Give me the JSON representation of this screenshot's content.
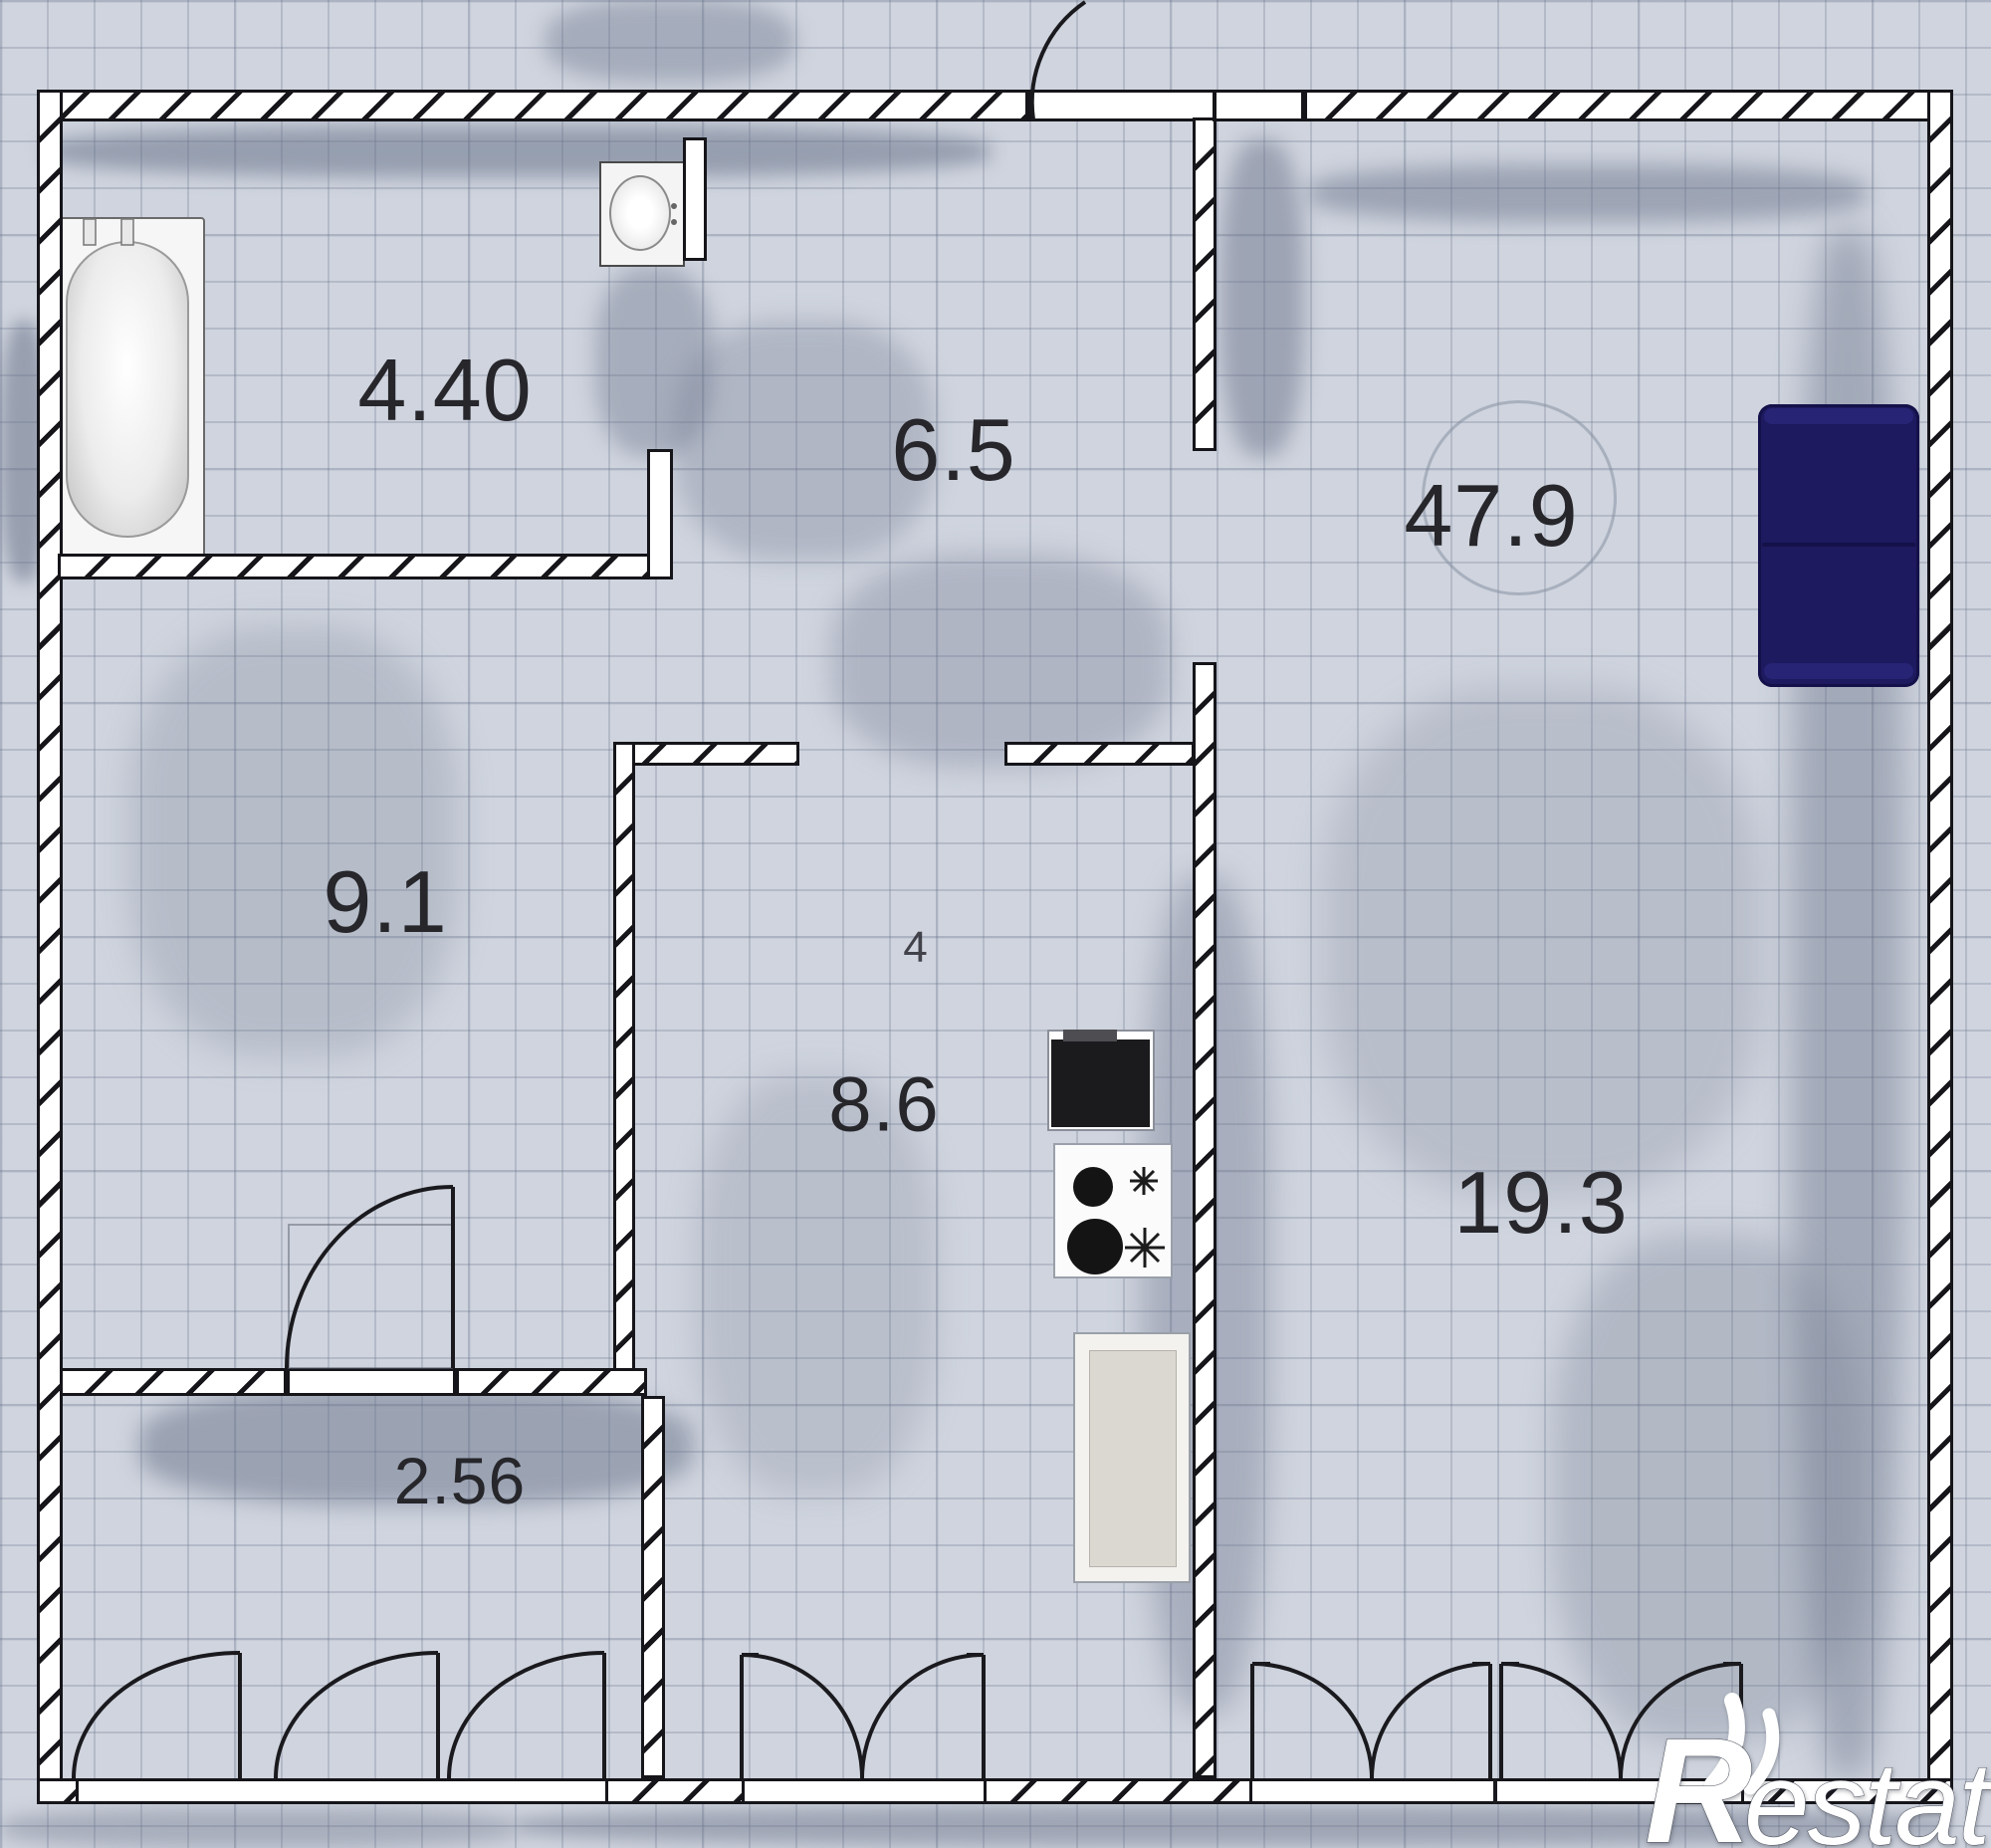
{
  "plan": {
    "type": "apartment floor plan",
    "rooms": {
      "bathroom": {
        "area": "4.40"
      },
      "hallway": {
        "area": "6.5"
      },
      "living_room": {
        "area": "47.9"
      },
      "bedroom": {
        "area": "9.1"
      },
      "kitchen": {
        "area": "8.6",
        "stray_mark": "4"
      },
      "bedroom2": {
        "area": "19.3"
      },
      "closet": {
        "area": "2.56"
      }
    },
    "fixtures": {
      "bathtub": "bathtub",
      "sink": "wash-basin",
      "sofa": "sofa",
      "refrigerator": "refrigerator",
      "stove": "two-burner-stove",
      "cabinet": "appliance-cabinet"
    },
    "watermark": {
      "r": "R",
      "rest": "estate"
    },
    "colors": {
      "background": "#cfd4de",
      "grid": "#6e7c96",
      "wall_fill": "#ffffff",
      "line": "#15151a",
      "sofa": "#1d1a5f",
      "refrigerator": "#1b1b1d",
      "watermark": "#ffffff"
    }
  }
}
